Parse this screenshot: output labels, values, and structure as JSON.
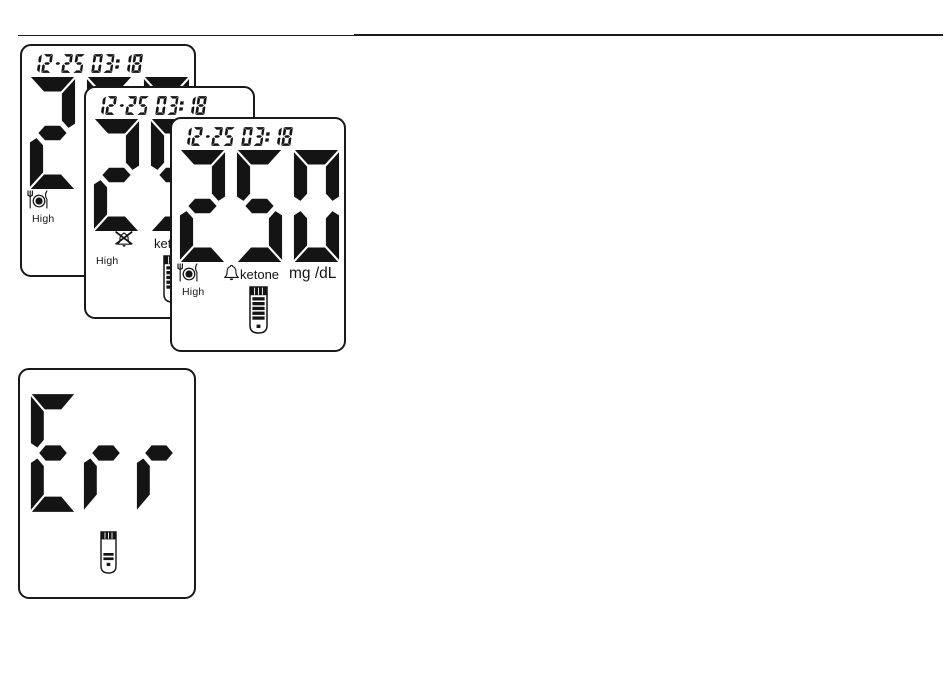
{
  "page": {
    "background": "#ffffff",
    "ink": "#141414"
  },
  "display": {
    "datetime": "12-25 03:18",
    "reading": "250",
    "error_code": "Err",
    "high_label": "High",
    "ketone_label": "ketone",
    "unit_label": "mg /dL"
  },
  "screens": [
    {
      "name": "lcd-screen-back",
      "datetime": "12-25 03:18",
      "reading": "250",
      "segments_lit": [
        "meal-icon",
        "high-label"
      ]
    },
    {
      "name": "lcd-screen-middle",
      "datetime": "12-25 03:18",
      "reading": "250",
      "segments_lit": [
        "bell-crossed-icon",
        "high-label",
        "ketone-label",
        "test-strip-icon"
      ]
    },
    {
      "name": "lcd-screen-front",
      "datetime": "12-25 03:18",
      "reading": "250",
      "segments_lit": [
        "meal-icon",
        "high-label",
        "bell-icon",
        "ketone-label",
        "unit-label",
        "test-strip-icon"
      ]
    },
    {
      "name": "lcd-screen-error",
      "reading": "Err",
      "segments_lit": [
        "test-strip-small-icon"
      ]
    }
  ]
}
